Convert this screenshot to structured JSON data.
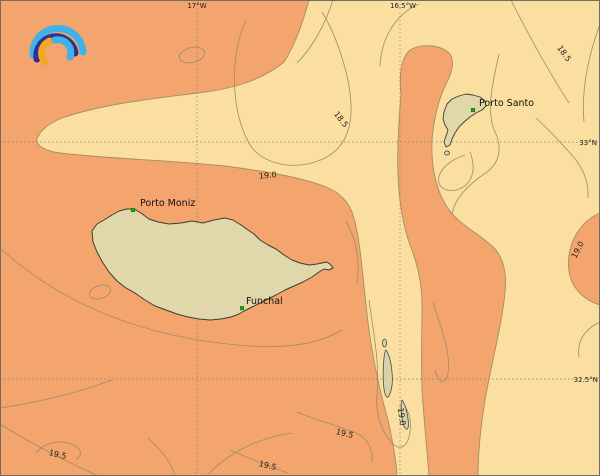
{
  "logo": {
    "name": "rainbow-arcs-logo",
    "colors": {
      "outer_arc": "#3FB3E8",
      "middle_arc": "#2E3192",
      "inner_left_arc": "#F5A623",
      "inner_right_arc": "#3FB3E8"
    }
  },
  "map": {
    "grid": {
      "longitude_labels": [
        {
          "text": "17°W"
        },
        {
          "text": "16.5°W"
        }
      ],
      "latitude_labels": [
        {
          "text": "33°N"
        },
        {
          "text": "32.5°N"
        }
      ]
    },
    "places": [
      {
        "name": "Porto Moniz"
      },
      {
        "name": "Funchal"
      },
      {
        "name": "Porto Santo"
      }
    ],
    "contour_labels": {
      "c185": "18.5",
      "c190": "19.0",
      "c195": "19.5"
    },
    "colors": {
      "band_cool": "#FADFA0",
      "band_warm": "#F4A46D",
      "island_fill": "#E0D8AA",
      "island_stroke": "#3C3C34",
      "contour_line": "#9C8B6F",
      "filled_contour_edge": "#A38F66",
      "grid_line": "#80807A",
      "city_marker": "#1FA51F"
    }
  }
}
